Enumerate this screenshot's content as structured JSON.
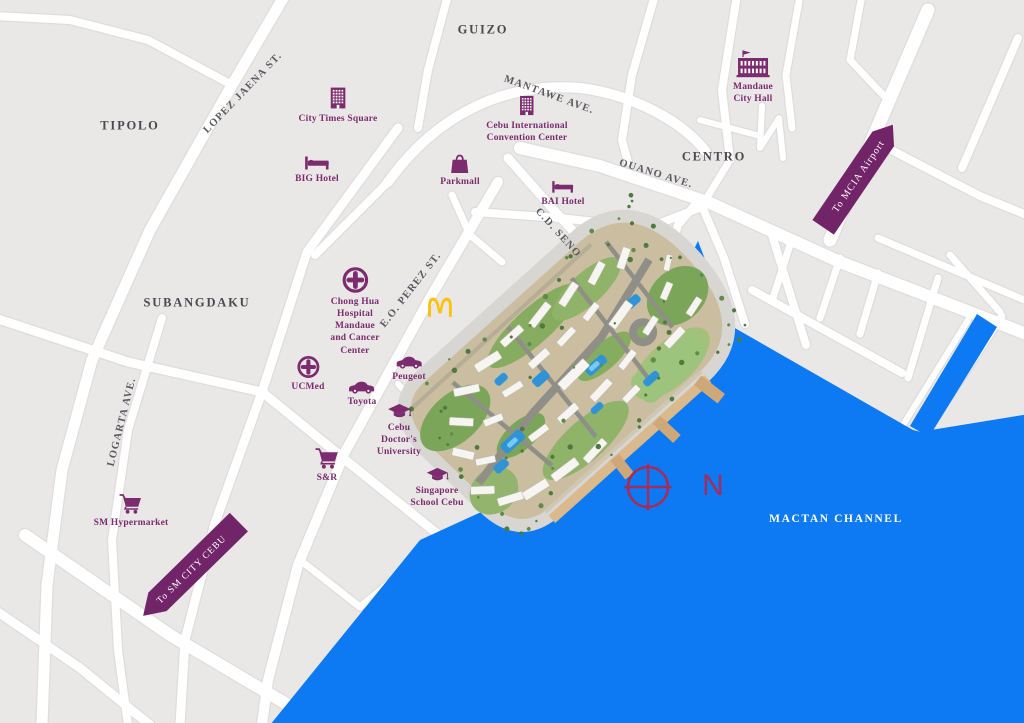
{
  "map": {
    "districts": [
      {
        "id": "tipolo",
        "label": "TIPOLO"
      },
      {
        "id": "guizo",
        "label": "GUIZO"
      },
      {
        "id": "centro",
        "label": "CENTRO"
      },
      {
        "id": "subangdaku",
        "label": "SUBANGDAKU"
      }
    ],
    "streets": [
      {
        "id": "lopez-jaena",
        "label": "LOPEZ JAENA ST."
      },
      {
        "id": "mantawe",
        "label": "MANTAWE AVE."
      },
      {
        "id": "ouano",
        "label": "OUANO AVE."
      },
      {
        "id": "cd-seno",
        "label": "C.D. SENO"
      },
      {
        "id": "eo-perez",
        "label": "E.O. PEREZ ST."
      },
      {
        "id": "logarta",
        "label": "LOGARTA AVE."
      }
    ],
    "pois": [
      {
        "id": "city-times-square",
        "label": "City Times Square",
        "icon": "building-icon"
      },
      {
        "id": "big-hotel",
        "label": "BIG Hotel",
        "icon": "hotel-bed-icon"
      },
      {
        "id": "cebu-international-convention-center",
        "label": "Cebu International\nConvention Center",
        "icon": "building-icon"
      },
      {
        "id": "parkmall",
        "label": "Parkmall",
        "icon": "shopping-bag-icon"
      },
      {
        "id": "bai-hotel",
        "label": "BAI Hotel",
        "icon": "hotel-bed-icon"
      },
      {
        "id": "mandaue-city-hall",
        "label": "Mandaue\nCity Hall",
        "icon": "city-hall-icon"
      },
      {
        "id": "chong-hua-hospital",
        "label": "Chong Hua\nHospital\nMandaue\nand Cancer\nCenter",
        "icon": "hospital-cross-icon"
      },
      {
        "id": "mcdonalds",
        "label": "",
        "icon": "mcdonalds-arches-icon"
      },
      {
        "id": "ucmed",
        "label": "UCMed",
        "icon": "hospital-cross-icon"
      },
      {
        "id": "toyota",
        "label": "Toyota",
        "icon": "car-icon"
      },
      {
        "id": "peugeot",
        "label": "Peugeot",
        "icon": "car-icon"
      },
      {
        "id": "cebu-doctors-university",
        "label": "Cebu\nDoctor's\nUniversity",
        "icon": "graduation-cap-icon"
      },
      {
        "id": "s-and-r",
        "label": "S&R",
        "icon": "shopping-cart-icon"
      },
      {
        "id": "singapore-school-cebu",
        "label": "Singapore\nSchool Cebu",
        "icon": "graduation-cap-icon"
      },
      {
        "id": "sm-hypermarket",
        "label": "SM Hypermarket",
        "icon": "shopping-cart-icon"
      }
    ],
    "direction_arrows": [
      {
        "id": "to-mcia-airport",
        "label": "To MCIA Airport"
      },
      {
        "id": "to-sm-city-cebu",
        "label": "To SM CITY CEBU"
      }
    ],
    "water_label": "MACTAN CHANNEL",
    "compass_label": "N",
    "colors": {
      "land": "#e9e8e7",
      "road": "#ffffff",
      "water": "#0d79f2",
      "brand_purple": "#7c2b6e",
      "arrow_purple": "#722468",
      "compass_crimson": "#a52d5c",
      "district_text": "#4b4950",
      "street_text": "#5a5860",
      "mcdonalds_gold": "#fdc10d"
    }
  }
}
